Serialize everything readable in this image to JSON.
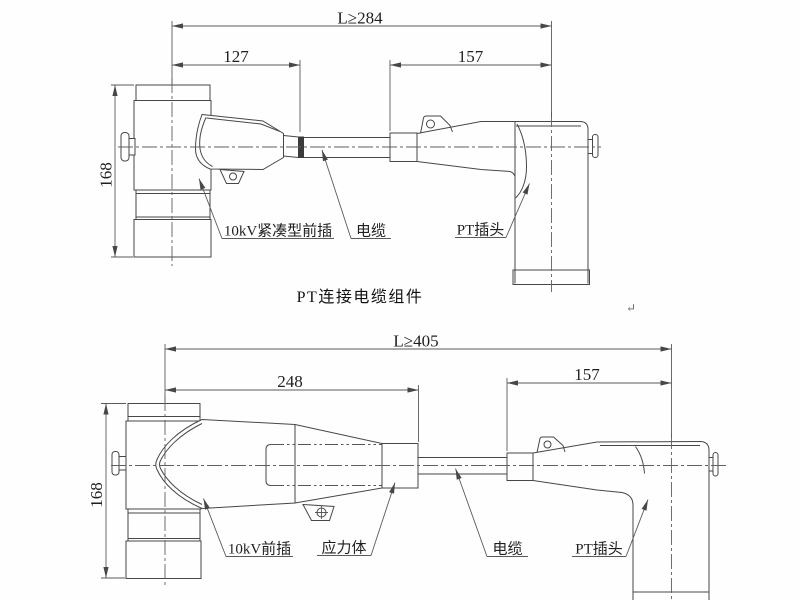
{
  "canvas": {
    "width": 800,
    "height": 600,
    "background": "#fefefe"
  },
  "palette": {
    "line": "#474747",
    "text": "#1f1f1f",
    "centerline": "#606060",
    "cable_band": "#3b3b3b"
  },
  "top": {
    "title": "PT连接电缆组件",
    "dims": {
      "overall": "L≥284",
      "left_section": "127",
      "right_section": "157",
      "height": "168"
    },
    "labels": {
      "front_plug": "10kV紧凑型前插",
      "cable": "电缆",
      "pt_plug": "PT插头"
    }
  },
  "bottom": {
    "dims": {
      "overall": "L≥405",
      "left_section": "248",
      "right_section": "157",
      "height": "168"
    },
    "labels": {
      "front_plug": "10kV前插",
      "stress_body": "应力体",
      "cable": "电缆",
      "pt_plug": "PT插头"
    },
    "return_mark": "↵"
  }
}
